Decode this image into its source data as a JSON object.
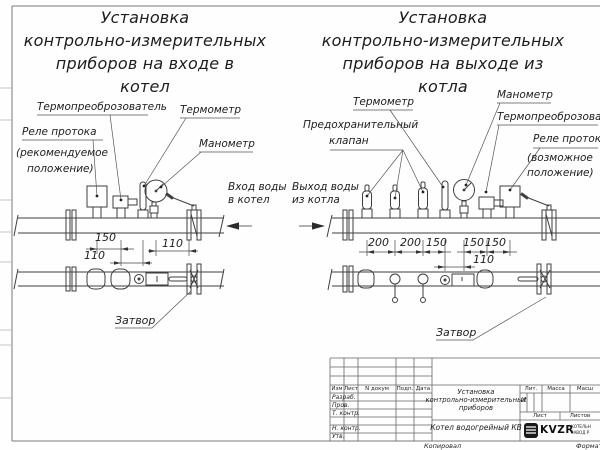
{
  "sheet": {
    "copied": "Копировал",
    "format": "Формат"
  },
  "inlet": {
    "title": [
      "Установка",
      "контрольно-измерительных",
      "приборов на входе в",
      "котел"
    ],
    "labels": {
      "transducer": "Термопреоброзователь",
      "thermometer": "Термометр",
      "flow_relay": [
        "Реле протока",
        "(рекомендуемое",
        "положение)"
      ],
      "manometer": "Манометр",
      "flow_in": [
        "Вход воды",
        "в котел"
      ],
      "valve": "Затвор"
    },
    "dims": [
      "150",
      "110",
      "110"
    ]
  },
  "outlet": {
    "title": [
      "Установка",
      "контрольно-измерительных",
      "приборов на выходе из",
      "котла"
    ],
    "labels": {
      "thermometer": "Термометр",
      "manometer": "Манометр",
      "transducer": "Термопреоброзователь",
      "safety_valve": [
        "Предохранительный",
        "клапан"
      ],
      "flow_relay": [
        "Реле протока",
        "(возможное",
        "положение)"
      ],
      "flow_out": [
        "Выход воды",
        "из котла"
      ],
      "valve": "Затвор"
    },
    "dims": [
      "200",
      "200",
      "150",
      "150",
      "150",
      "110"
    ]
  },
  "title_block": {
    "rev_cols": [
      "Изм",
      "Лист",
      "N докум",
      "Подп.",
      "Дата"
    ],
    "sign_rows": [
      "Разраб.",
      "Пров.",
      "Т. контр.",
      "Н. контр.",
      "Утв."
    ],
    "doc_title": [
      "Установка",
      "контрольно-измерительных",
      "приборов"
    ],
    "product": "Котел водогрейный КВ",
    "lit_label": "Лит.",
    "lit_value": "И",
    "mass_label": "Масса",
    "scale_label": "Масш",
    "sheet_label": "Лист",
    "sheets_label": "Листов",
    "logo": {
      "name": "KVZR",
      "sub": [
        "КОТЕЛЬН",
        "ЗАВОД Р"
      ]
    }
  }
}
